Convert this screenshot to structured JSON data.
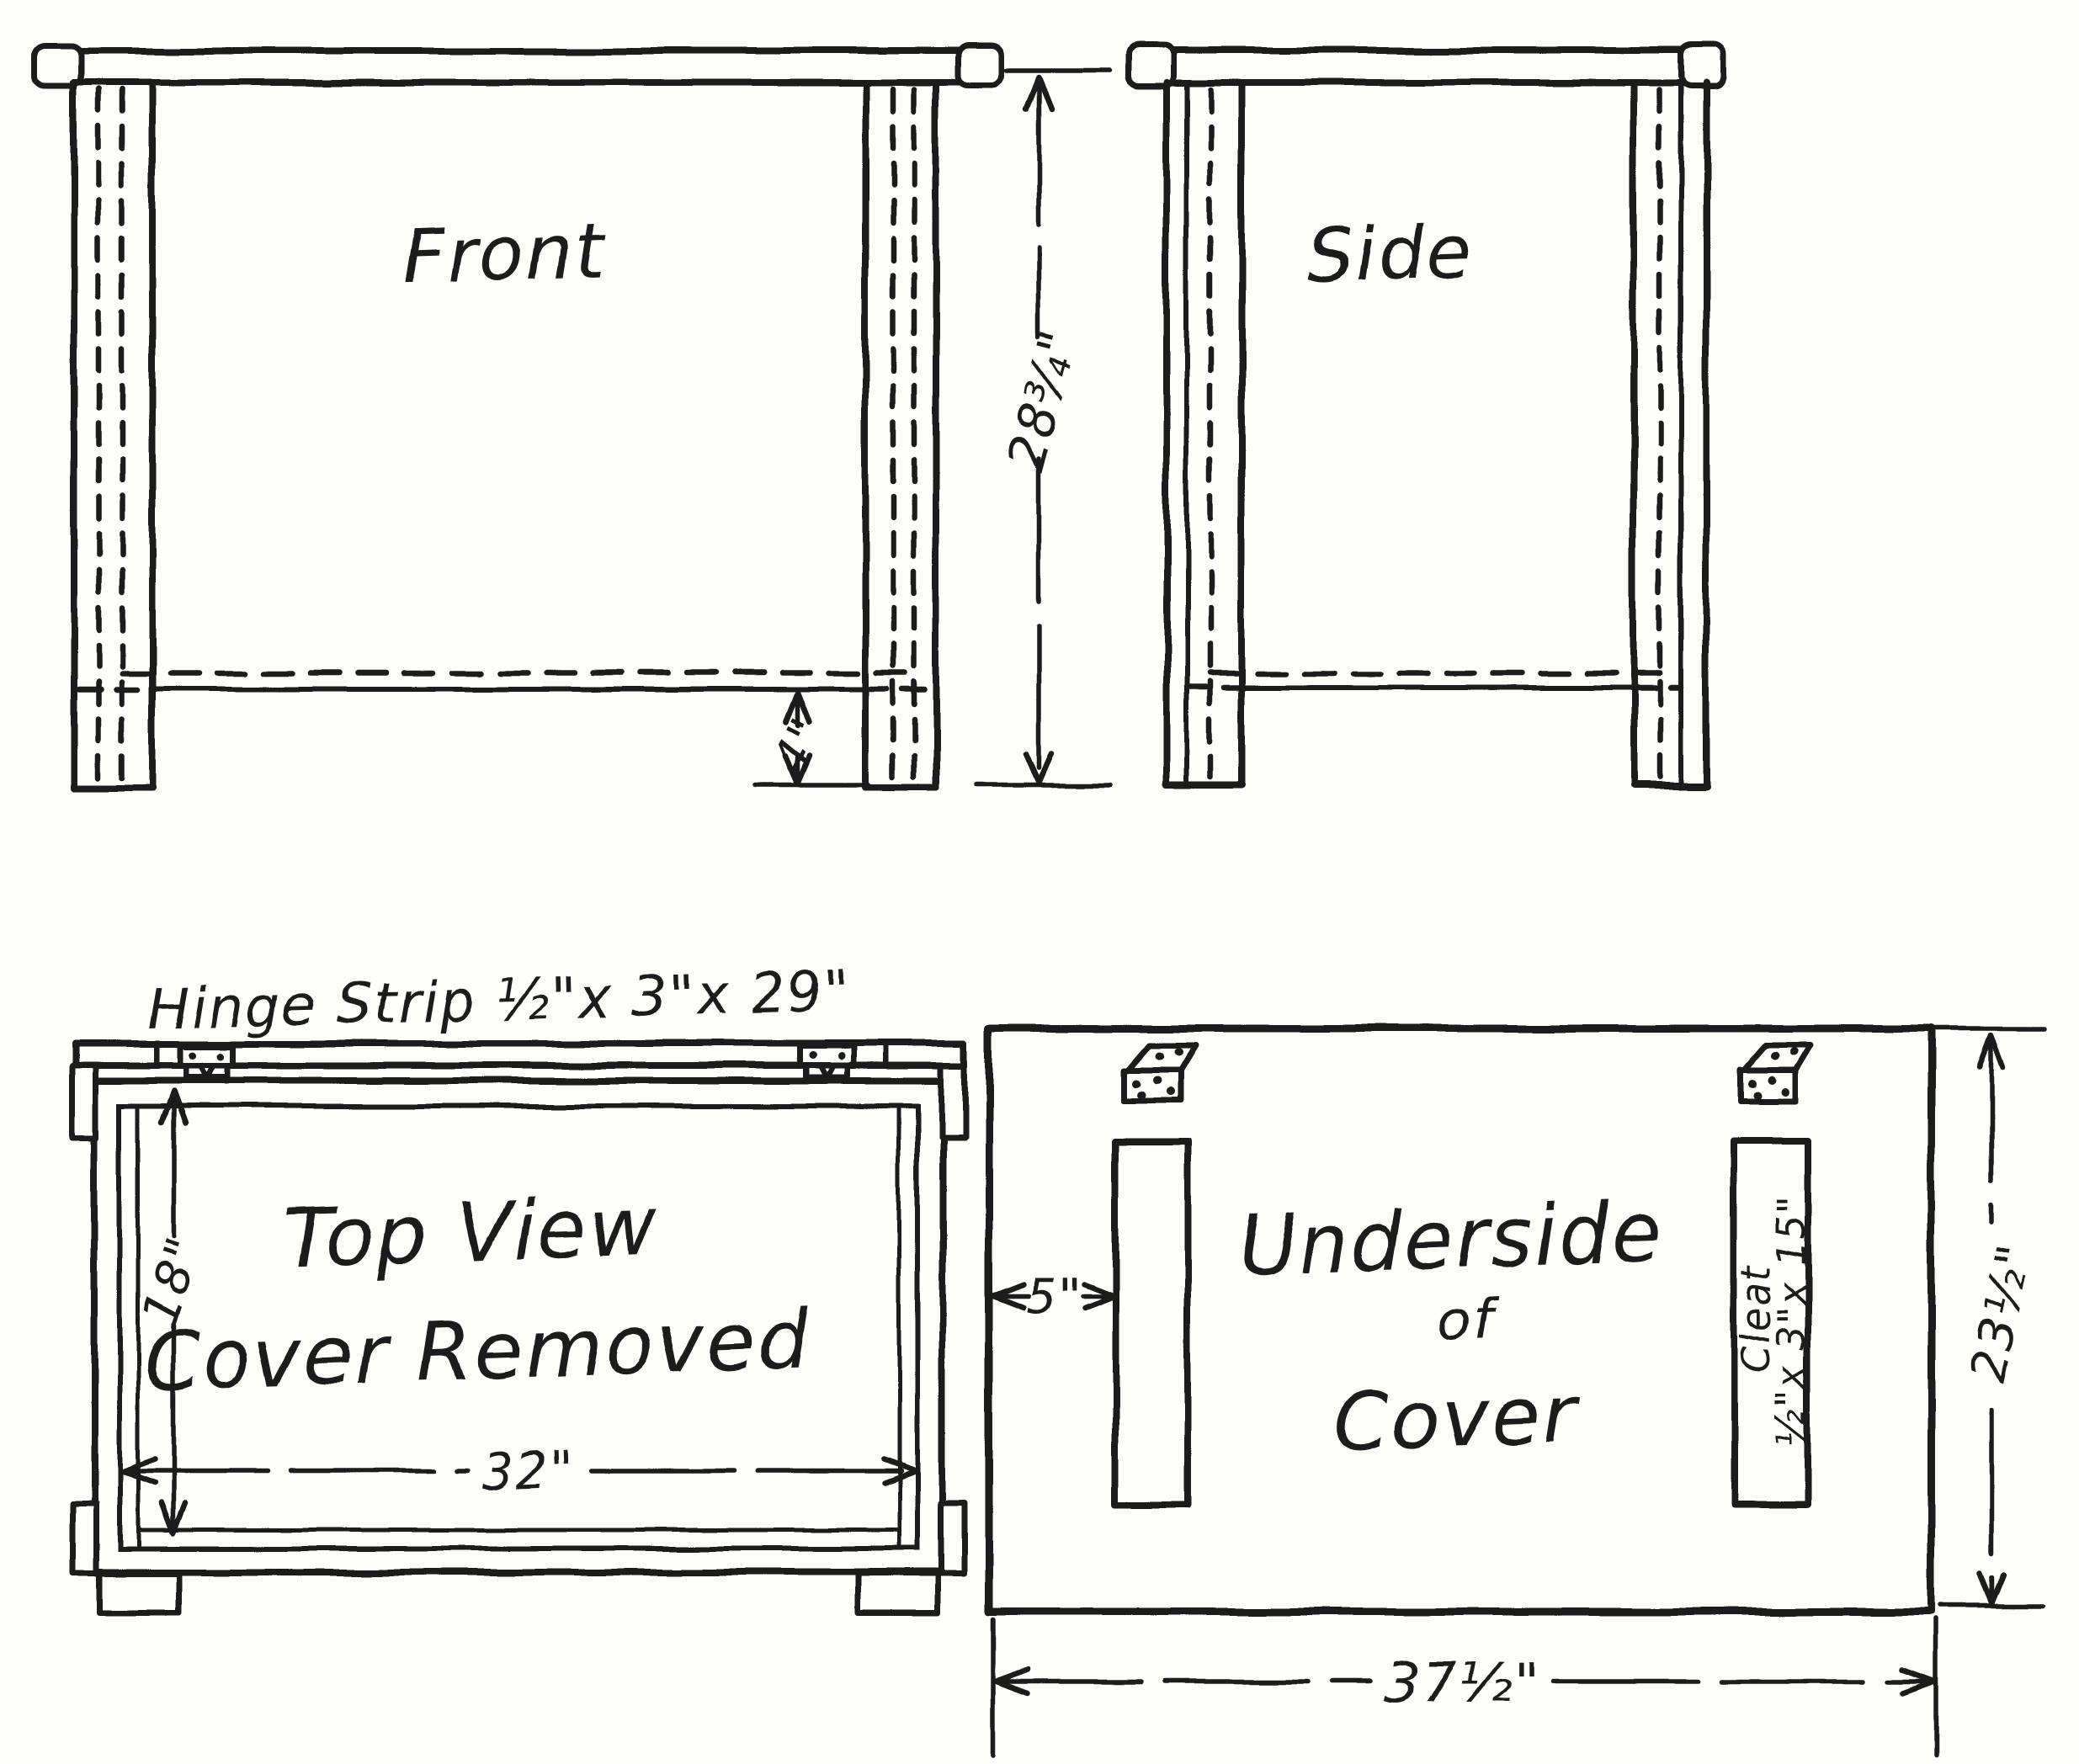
{
  "palette": {
    "ink": "#1a1a1a",
    "paper": "#fdfdfa"
  },
  "views": {
    "front": {
      "label": "Front",
      "height_dim": "28¾\"",
      "foot_dim": "4\""
    },
    "side": {
      "label": "Side"
    },
    "top": {
      "hinge_note": "Hinge Strip ½\"x 3\"x 29\"",
      "title_line1": "Top View",
      "title_line2": "Cover Removed",
      "depth_dim": "18\"",
      "width_dim": "32\""
    },
    "underside": {
      "title_line1": "Underside",
      "title_line2": "of",
      "title_line3": "Cover",
      "cleat_line1": "Cleat",
      "cleat_line2": "½\"x 3\"x 15\"",
      "inset_dim": "5\"",
      "depth_dim": "23½\"",
      "width_dim": "37½\""
    }
  }
}
